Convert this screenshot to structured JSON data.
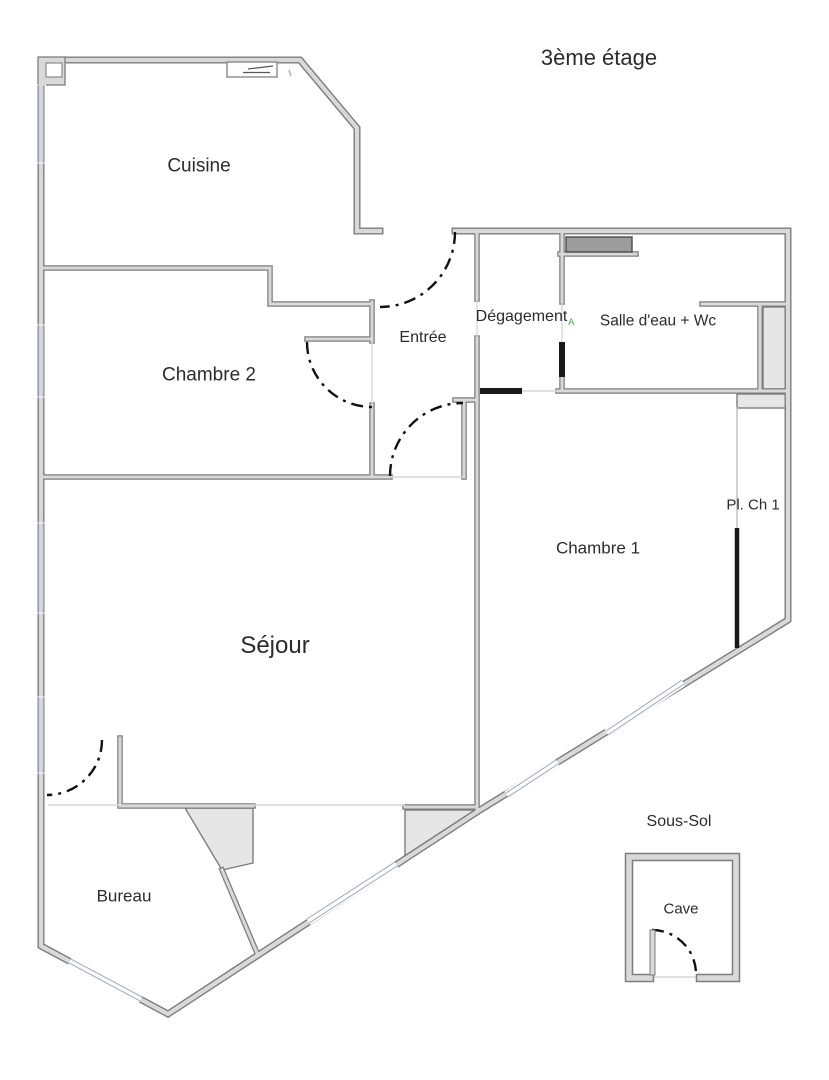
{
  "title": "3ème étage",
  "plan": {
    "rooms": {
      "cuisine": "Cuisine",
      "chambre2": "Chambre 2",
      "entree": "Entrée",
      "degagement": "Dégagement",
      "salle_eau": "Salle d'eau + Wc",
      "chambre1": "Chambre 1",
      "pl_ch1": "Pl. Ch 1",
      "sejour": "Séjour",
      "bureau": "Bureau"
    },
    "degagement_marker": "A",
    "basement": {
      "title": "Sous-Sol",
      "room": "Cave"
    }
  },
  "colors": {
    "wall_edge": "#7d7d7d",
    "wall_fill": "#d9d9d9",
    "door_arc": "#111111",
    "window_line": "#a8aec6",
    "closet_fill": "#e6e6e6",
    "dark_unit_fill": "#9c9c9c",
    "marker_green": "#3fa34d",
    "text": "#2b2b2b",
    "bg": "#ffffff"
  }
}
